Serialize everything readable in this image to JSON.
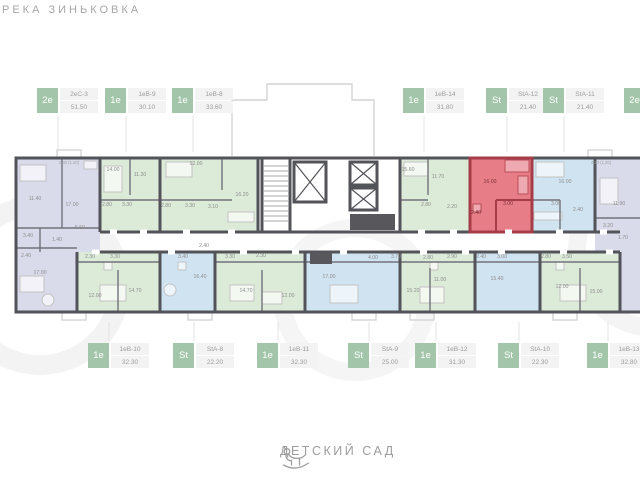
{
  "title": "РЕКА ЗИНЬКОВКА",
  "footer": {
    "label": "ДЕТСКИЙ САД",
    "icon": "rocking-horse-icon"
  },
  "highlighted_unit": "StA-12",
  "palette": {
    "badge_green": "#a3c6aa",
    "wall": "#53535a",
    "unit_green": "#dcead8",
    "unit_blue": "#cfe3f0",
    "unit_lavender": "#d9daea",
    "unit_highlight": "#e2606c",
    "highlight_wall": "#a53d49"
  },
  "labels_top": [
    {
      "type": "2е",
      "unit": "2еС-3",
      "area": "51.50",
      "x": 37
    },
    {
      "type": "1е",
      "unit": "1еВ-9",
      "area": "30.10",
      "x": 105
    },
    {
      "type": "1е",
      "unit": "1еВ-8",
      "area": "33.60",
      "x": 172
    },
    {
      "type": "1е",
      "unit": "1еВ-14",
      "area": "31.80",
      "x": 403
    },
    {
      "type": "St",
      "unit": "StA-12",
      "area": "21.40",
      "x": 486
    },
    {
      "type": "St",
      "unit": "StA-11",
      "area": "21.40",
      "x": 543
    },
    {
      "type": "2е",
      "unit": "",
      "area": "",
      "x": 624
    }
  ],
  "labels_bottom": [
    {
      "type": "1е",
      "unit": "1еВ-10",
      "area": "32.30",
      "x": 88
    },
    {
      "type": "St",
      "unit": "StA-8",
      "area": "22.20",
      "x": 173
    },
    {
      "type": "1е",
      "unit": "1еВ-11",
      "area": "32.30",
      "x": 257
    },
    {
      "type": "St",
      "unit": "StA-9",
      "area": "25.00",
      "x": 348
    },
    {
      "type": "1е",
      "unit": "1еВ-12",
      "area": "31.30",
      "x": 415
    },
    {
      "type": "St",
      "unit": "StA-10",
      "area": "22.30",
      "x": 498
    },
    {
      "type": "1е",
      "unit": "1еВ-13",
      "area": "32.80",
      "x": 587
    }
  ],
  "rooms": [
    {
      "t": "11.40",
      "x": 35,
      "y": 200
    },
    {
      "t": "17.00",
      "x": 72,
      "y": 206
    },
    {
      "t": "5.50",
      "x": 80,
      "y": 229
    },
    {
      "t": "3.40",
      "x": 28,
      "y": 237
    },
    {
      "t": "1.40",
      "x": 57,
      "y": 241
    },
    {
      "t": "2.40",
      "x": 26,
      "y": 257
    },
    {
      "t": "17.00",
      "x": 40,
      "y": 274
    },
    {
      "t": "14.00",
      "x": 113,
      "y": 171
    },
    {
      "t": "11.30",
      "x": 140,
      "y": 176
    },
    {
      "t": "2.80",
      "x": 107,
      "y": 206
    },
    {
      "t": "3.30",
      "x": 127,
      "y": 206
    },
    {
      "t": "12.00",
      "x": 196,
      "y": 165
    },
    {
      "t": "16.20",
      "x": 242,
      "y": 196
    },
    {
      "t": "2.80",
      "x": 166,
      "y": 207
    },
    {
      "t": "3.30",
      "x": 190,
      "y": 207
    },
    {
      "t": "3.10",
      "x": 213,
      "y": 208
    },
    {
      "t": "15.60",
      "x": 408,
      "y": 171
    },
    {
      "t": "11.70",
      "x": 438,
      "y": 178
    },
    {
      "t": "2.80",
      "x": 426,
      "y": 206
    },
    {
      "t": "2.20",
      "x": 452,
      "y": 208
    },
    {
      "t": "16.00",
      "x": 490,
      "y": 183,
      "k": "red"
    },
    {
      "t": "3.00",
      "x": 508,
      "y": 205,
      "k": "red"
    },
    {
      "t": "2.40",
      "x": 476,
      "y": 214,
      "k": "red"
    },
    {
      "t": "16.00",
      "x": 565,
      "y": 183
    },
    {
      "t": "3.00",
      "x": 556,
      "y": 205
    },
    {
      "t": "2.40",
      "x": 578,
      "y": 211
    },
    {
      "t": "11.90",
      "x": 619,
      "y": 205
    },
    {
      "t": "3.20",
      "x": 608,
      "y": 227
    },
    {
      "t": "1.70",
      "x": 623,
      "y": 239
    },
    {
      "t": "2.30 (1.20)",
      "x": 69,
      "y": 164,
      "s": true
    },
    {
      "t": "2.30 (1.20)",
      "x": 601,
      "y": 164,
      "s": true
    },
    {
      "t": "12.00",
      "x": 95,
      "y": 297
    },
    {
      "t": "14.70",
      "x": 135,
      "y": 292
    },
    {
      "t": "2.30",
      "x": 90,
      "y": 258
    },
    {
      "t": "3.30",
      "x": 115,
      "y": 258
    },
    {
      "t": "16.40",
      "x": 200,
      "y": 278
    },
    {
      "t": "3.40",
      "x": 183,
      "y": 258
    },
    {
      "t": "2.40",
      "x": 204,
      "y": 247
    },
    {
      "t": "14.70",
      "x": 246,
      "y": 292
    },
    {
      "t": "12.00",
      "x": 288,
      "y": 297
    },
    {
      "t": "3.30",
      "x": 230,
      "y": 258
    },
    {
      "t": "2.30",
      "x": 261,
      "y": 257
    },
    {
      "t": "17.00",
      "x": 329,
      "y": 278
    },
    {
      "t": "4.00",
      "x": 373,
      "y": 259
    },
    {
      "t": "3.70",
      "x": 396,
      "y": 258
    },
    {
      "t": "15.20",
      "x": 413,
      "y": 292
    },
    {
      "t": "11.00",
      "x": 440,
      "y": 281
    },
    {
      "t": "2.80",
      "x": 428,
      "y": 259
    },
    {
      "t": "2.90",
      "x": 452,
      "y": 258
    },
    {
      "t": "15.40",
      "x": 497,
      "y": 280
    },
    {
      "t": "2.40",
      "x": 481,
      "y": 258
    },
    {
      "t": "3.00",
      "x": 502,
      "y": 258
    },
    {
      "t": "12.00",
      "x": 562,
      "y": 288
    },
    {
      "t": "15.00",
      "x": 596,
      "y": 293
    },
    {
      "t": "2.80",
      "x": 546,
      "y": 258
    },
    {
      "t": "3.50",
      "x": 567,
      "y": 258
    }
  ]
}
